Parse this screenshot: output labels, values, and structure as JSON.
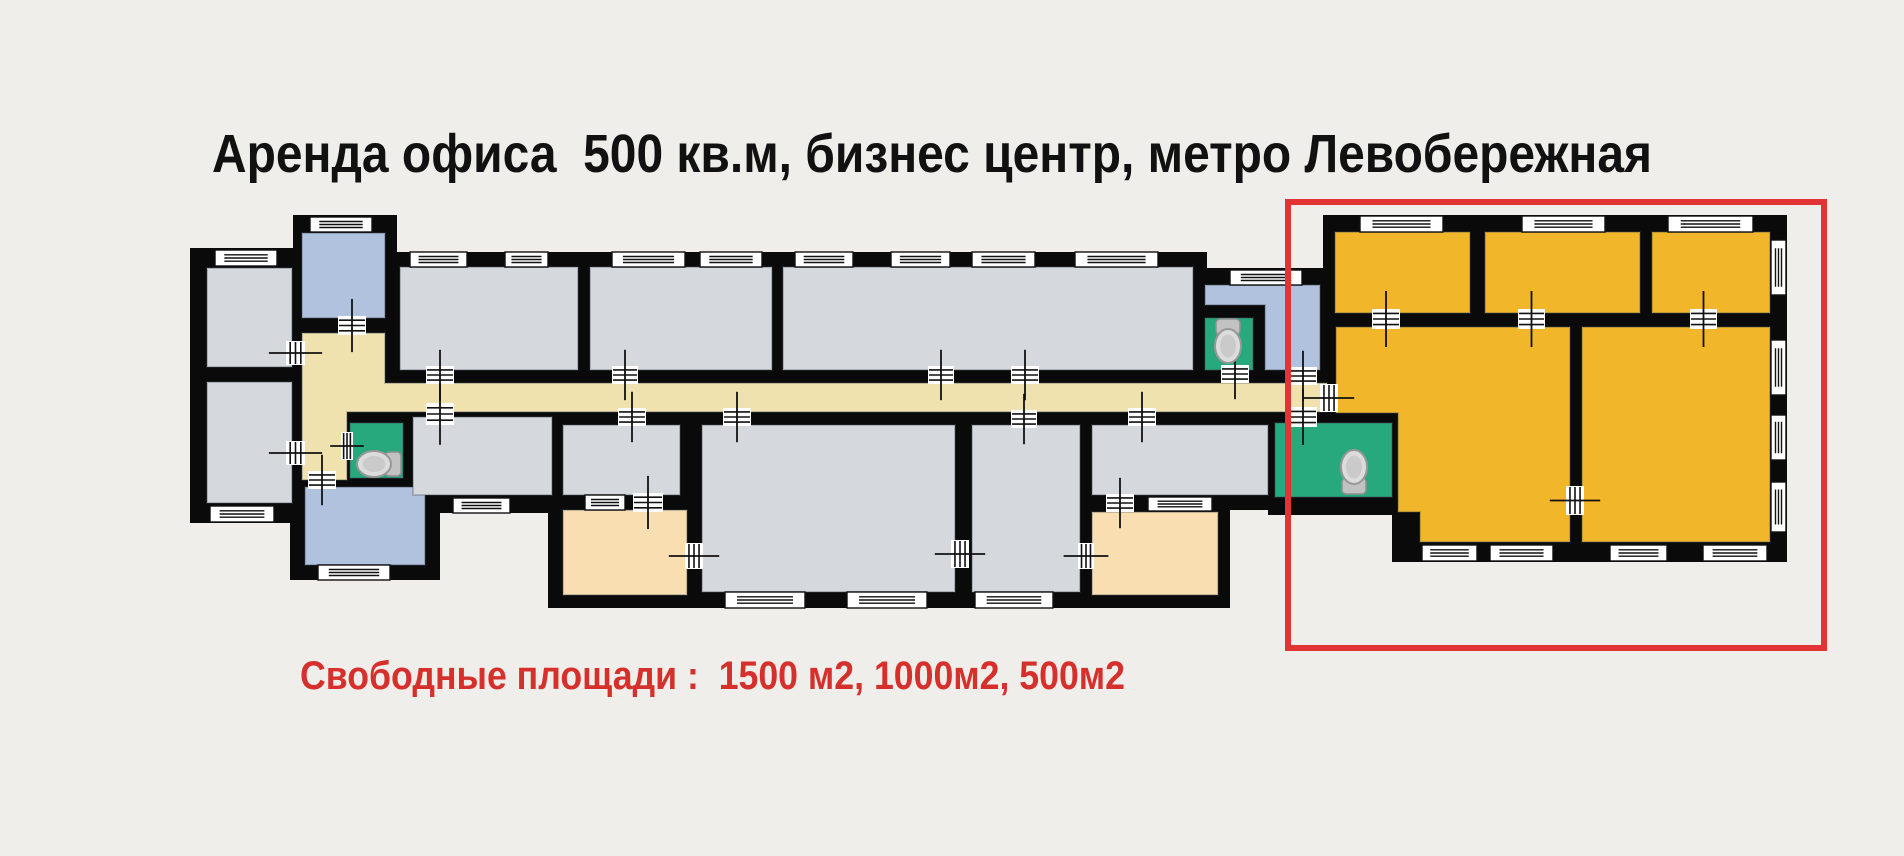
{
  "title": "Аренда офиса  500 кв.м, бизнес центр, метро Левобережная",
  "subtitle": "Свободные площади :  1500 м2, 1000м2, 500м2",
  "colors": {
    "background": "#f0eeea",
    "wall": "#0a0a0a",
    "room_gray": "#d5d9dd",
    "room_blue": "#b0c2de",
    "room_yellow": "#f2b62a",
    "room_cream": "#f8deb0",
    "corridor": "#efe2af",
    "wc_green": "#28a87d",
    "window_white": "#ffffff",
    "highlight_red": "#e23434",
    "title_color": "#111111",
    "subtitle_red": "#d6302c"
  },
  "floor_plan": {
    "canvas": {
      "width": 1904,
      "height": 851
    },
    "walls": [
      {
        "rect": [
          190,
          248,
          122,
          275
        ]
      },
      {
        "rect": [
          293,
          215,
          104,
          120
        ]
      },
      {
        "rect": [
          285,
          320,
          130,
          170
        ]
      },
      {
        "rect": [
          290,
          475,
          150,
          105
        ]
      },
      {
        "rect": [
          385,
          252,
          822,
          131
        ]
      },
      {
        "rect": [
          1193,
          268,
          147,
          115
        ]
      },
      {
        "rect": [
          285,
          370,
          1055,
          70
        ]
      },
      {
        "rect": [
          400,
          412,
          163,
          101
        ]
      },
      {
        "rect": [
          548,
          412,
          154,
          196
        ]
      },
      {
        "rect": [
          690,
          412,
          402,
          196
        ]
      },
      {
        "rect": [
          1080,
          412,
          200,
          98
        ]
      },
      {
        "rect": [
          1080,
          500,
          150,
          108
        ]
      },
      {
        "rect": [
          1268,
          412,
          134,
          103
        ]
      },
      {
        "poly": [
          [
            1323,
            215
          ],
          [
            1787,
            215
          ],
          [
            1787,
            562
          ],
          [
            1392,
            562
          ],
          [
            1392,
            512
          ],
          [
            1323,
            512
          ]
        ]
      }
    ],
    "rooms": [
      {
        "name": "room-left-top",
        "fill": "room_gray",
        "rect": [
          207,
          268,
          85,
          99
        ]
      },
      {
        "name": "room-left-bottom",
        "fill": "room_gray",
        "rect": [
          207,
          382,
          85,
          121
        ]
      },
      {
        "name": "room-blue-top",
        "fill": "room_blue",
        "rect": [
          302,
          233,
          83,
          85
        ]
      },
      {
        "name": "corridor",
        "fill": "corridor",
        "poly": [
          [
            302,
            333
          ],
          [
            385,
            333
          ],
          [
            385,
            383
          ],
          [
            1327,
            383
          ],
          [
            1327,
            412
          ],
          [
            347,
            412
          ],
          [
            347,
            480
          ],
          [
            302,
            480
          ]
        ]
      },
      {
        "name": "wc-left",
        "fill": "wc_green",
        "rect": [
          350,
          423,
          53,
          55
        ]
      },
      {
        "name": "room-blue-bottom",
        "fill": "room_blue",
        "rect": [
          305,
          487,
          120,
          78
        ]
      },
      {
        "name": "room-top-1",
        "fill": "room_gray",
        "rect": [
          400,
          267,
          178,
          103
        ]
      },
      {
        "name": "room-top-2",
        "fill": "room_gray",
        "rect": [
          590,
          267,
          182,
          103
        ]
      },
      {
        "name": "room-top-3",
        "fill": "room_gray",
        "rect": [
          783,
          267,
          410,
          103
        ]
      },
      {
        "name": "room-blue-right",
        "fill": "room_blue",
        "poly": [
          [
            1205,
            285
          ],
          [
            1320,
            285
          ],
          [
            1320,
            370
          ],
          [
            1265,
            370
          ],
          [
            1265,
            305
          ],
          [
            1205,
            305
          ]
        ]
      },
      {
        "name": "wc-middle",
        "fill": "wc_green",
        "rect": [
          1205,
          318,
          48,
          52
        ]
      },
      {
        "name": "room-bottom-1",
        "fill": "room_gray",
        "rect": [
          413,
          417,
          139,
          78
        ]
      },
      {
        "name": "room-bottom-2",
        "fill": "room_gray",
        "rect": [
          563,
          425,
          117,
          70
        ]
      },
      {
        "name": "room-cream-1",
        "fill": "room_cream",
        "rect": [
          563,
          510,
          124,
          85
        ]
      },
      {
        "name": "room-bottom-3",
        "fill": "room_gray",
        "rect": [
          702,
          425,
          253,
          167
        ]
      },
      {
        "name": "room-bottom-4",
        "fill": "room_gray",
        "rect": [
          972,
          425,
          108,
          167
        ]
      },
      {
        "name": "room-bottom-5",
        "fill": "room_gray",
        "rect": [
          1092,
          425,
          176,
          70
        ]
      },
      {
        "name": "room-cream-2",
        "fill": "room_cream",
        "rect": [
          1092,
          512,
          126,
          83
        ]
      },
      {
        "name": "wc-right",
        "fill": "wc_green",
        "rect": [
          1275,
          423,
          117,
          74
        ]
      },
      {
        "name": "room-yellow-1",
        "fill": "room_yellow",
        "rect": [
          1335,
          232,
          135,
          81
        ]
      },
      {
        "name": "room-yellow-2",
        "fill": "room_yellow",
        "rect": [
          1485,
          232,
          155,
          81
        ]
      },
      {
        "name": "room-yellow-3",
        "fill": "room_yellow",
        "rect": [
          1652,
          232,
          118,
          81
        ]
      },
      {
        "name": "room-yellow-4",
        "fill": "room_yellow",
        "poly": [
          [
            1336,
            327
          ],
          [
            1570,
            327
          ],
          [
            1570,
            542
          ],
          [
            1420,
            542
          ],
          [
            1420,
            512
          ],
          [
            1398,
            512
          ],
          [
            1398,
            413
          ],
          [
            1336,
            413
          ]
        ]
      },
      {
        "name": "room-yellow-5",
        "fill": "room_yellow",
        "rect": [
          1582,
          327,
          188,
          215
        ]
      }
    ],
    "windows": [
      {
        "rect": [
          215,
          250,
          62,
          16
        ]
      },
      {
        "rect": [
          210,
          506,
          64,
          16
        ]
      },
      {
        "rect": [
          310,
          217,
          62,
          15
        ]
      },
      {
        "rect": [
          318,
          565,
          72,
          15
        ]
      },
      {
        "rect": [
          410,
          252,
          57,
          15
        ]
      },
      {
        "rect": [
          505,
          252,
          43,
          15
        ]
      },
      {
        "rect": [
          612,
          252,
          73,
          15
        ]
      },
      {
        "rect": [
          700,
          252,
          62,
          15
        ]
      },
      {
        "rect": [
          795,
          252,
          58,
          15
        ]
      },
      {
        "rect": [
          891,
          252,
          59,
          15
        ]
      },
      {
        "rect": [
          972,
          252,
          63,
          15
        ]
      },
      {
        "rect": [
          1075,
          252,
          83,
          15
        ]
      },
      {
        "rect": [
          1230,
          270,
          72,
          15
        ]
      },
      {
        "rect": [
          453,
          498,
          57,
          15
        ]
      },
      {
        "rect": [
          585,
          495,
          40,
          15
        ]
      },
      {
        "rect": [
          725,
          592,
          80,
          16
        ]
      },
      {
        "rect": [
          847,
          592,
          80,
          16
        ]
      },
      {
        "rect": [
          975,
          592,
          78,
          16
        ]
      },
      {
        "rect": [
          1148,
          497,
          64,
          14
        ]
      },
      {
        "rect": [
          1360,
          216,
          83,
          16
        ]
      },
      {
        "rect": [
          1522,
          216,
          83,
          16
        ]
      },
      {
        "rect": [
          1668,
          216,
          85,
          16
        ]
      },
      {
        "rect": [
          1771,
          240,
          15,
          55
        ]
      },
      {
        "rect": [
          1771,
          340,
          15,
          55
        ]
      },
      {
        "rect": [
          1771,
          415,
          15,
          45
        ]
      },
      {
        "rect": [
          1771,
          482,
          15,
          50
        ]
      },
      {
        "rect": [
          1422,
          545,
          55,
          16
        ]
      },
      {
        "rect": [
          1490,
          545,
          63,
          16
        ]
      },
      {
        "rect": [
          1610,
          545,
          57,
          16
        ]
      },
      {
        "rect": [
          1703,
          545,
          64,
          16
        ]
      }
    ],
    "doors": [
      {
        "rect": [
          338,
          316,
          28,
          19
        ]
      },
      {
        "rect": [
          286,
          341,
          19,
          24
        ]
      },
      {
        "rect": [
          286,
          441,
          19,
          24
        ]
      },
      {
        "rect": [
          341,
          432,
          12,
          28
        ]
      },
      {
        "rect": [
          308,
          471,
          28,
          18
        ]
      },
      {
        "rect": [
          426,
          366,
          28,
          18
        ]
      },
      {
        "rect": [
          612,
          366,
          26,
          18
        ]
      },
      {
        "rect": [
          426,
          403,
          28,
          22
        ]
      },
      {
        "rect": [
          618,
          408,
          28,
          18
        ]
      },
      {
        "rect": [
          723,
          408,
          28,
          18
        ]
      },
      {
        "rect": [
          928,
          366,
          26,
          18
        ]
      },
      {
        "rect": [
          1011,
          366,
          28,
          18
        ]
      },
      {
        "rect": [
          1011,
          410,
          26,
          18
        ]
      },
      {
        "rect": [
          1128,
          408,
          28,
          18
        ]
      },
      {
        "rect": [
          1106,
          494,
          28,
          18
        ]
      },
      {
        "rect": [
          633,
          493,
          30,
          19
        ]
      },
      {
        "rect": [
          1221,
          365,
          28,
          18
        ]
      },
      {
        "rect": [
          1289,
          367,
          28,
          18
        ]
      },
      {
        "rect": [
          1289,
          407,
          28,
          20
        ]
      },
      {
        "rect": [
          1320,
          384,
          18,
          28
        ]
      },
      {
        "rect": [
          685,
          543,
          18,
          26
        ]
      },
      {
        "rect": [
          951,
          540,
          18,
          28
        ]
      },
      {
        "rect": [
          1078,
          543,
          16,
          26
        ]
      },
      {
        "rect": [
          1372,
          309,
          28,
          20
        ]
      },
      {
        "rect": [
          1518,
          309,
          27,
          20
        ]
      },
      {
        "rect": [
          1690,
          309,
          27,
          20
        ]
      },
      {
        "rect": [
          1566,
          486,
          18,
          29
        ]
      }
    ],
    "toilets": [
      {
        "cx": 378,
        "cy": 464,
        "dir": "left"
      },
      {
        "cx": 1228,
        "cy": 342,
        "dir": "down"
      },
      {
        "cx": 1354,
        "cy": 471,
        "dir": "up"
      }
    ],
    "highlight": {
      "rect": [
        1288,
        202,
        536,
        446
      ],
      "stroke_width": 6
    }
  }
}
